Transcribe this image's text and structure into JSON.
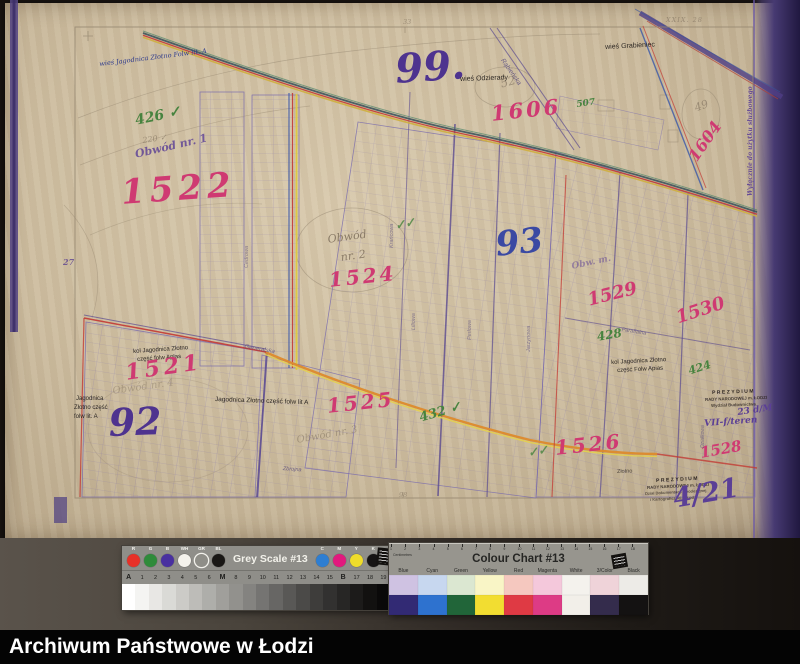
{
  "caption": {
    "text": "Archiwum Państwowe w Łodzi"
  },
  "palette": {
    "pink": "#cf3a72",
    "purple": "#4e338f",
    "blue": "#3a49a3",
    "ink": "#2d3a8c",
    "black": "#2b2622",
    "green": "#47833f",
    "pencil": "#8a7b67",
    "stamp": "#2c2420",
    "hand": "#5b3f96",
    "street": "#564a7e",
    "paper": "#cdbda0",
    "edge_band": "#544683",
    "road_orange": "#dd8a2c",
    "road_red": "#c33a33",
    "road_yellow": "#ddc93f",
    "road_blue": "#3a57a8"
  },
  "map": {
    "annotations": [
      {
        "n": "village-label-jagodnica-folw",
        "t": "wieś Jagodnica Złotno Folw lit. A",
        "x": 99,
        "y": 61,
        "s": 6.5,
        "st": "ink",
        "r": -7
      },
      {
        "n": "green-number-426",
        "t": "426 ✓",
        "x": 134,
        "y": 114,
        "s": 14,
        "st": "green",
        "r": -12
      },
      {
        "n": "pencil-number-220",
        "t": "220 ✓",
        "x": 142,
        "y": 137,
        "s": 8,
        "st": "pencil",
        "r": -8,
        "o": 0.7
      },
      {
        "n": "obwod-label-1",
        "t": "Obwód nr. 1",
        "x": 134,
        "y": 149,
        "s": 11,
        "st": "hand",
        "r": -13,
        "o": 0.8
      },
      {
        "n": "parcel-number-1522",
        "t": "1522",
        "x": 120,
        "y": 176,
        "s": 34,
        "st": "pink",
        "r": -4,
        "ls": 5
      },
      {
        "n": "district-number-99",
        "t": "99.",
        "x": 394,
        "y": 50,
        "s": 40,
        "st": "purple",
        "r": -4
      },
      {
        "n": "village-label-odzierady",
        "t": "wieś Odzierady",
        "x": 460,
        "y": 76,
        "s": 7,
        "st": "black",
        "r": -2
      },
      {
        "n": "pencil-number-52",
        "t": "52",
        "x": 499,
        "y": 78,
        "s": 12,
        "st": "pencil",
        "r": -15,
        "o": 0.7
      },
      {
        "n": "parcel-number-1606",
        "t": "1606",
        "x": 490,
        "y": 103,
        "s": 21,
        "st": "pink",
        "r": -6,
        "ls": 3
      },
      {
        "n": "green-number-507",
        "t": "507",
        "x": 576,
        "y": 101,
        "s": 9,
        "st": "green",
        "r": -8
      },
      {
        "n": "village-label-grabieniec",
        "t": "wieś Grabieniec",
        "x": 605,
        "y": 44,
        "s": 7,
        "st": "black",
        "r": -3
      },
      {
        "n": "sheet-number-top",
        "t": "XXIX. 28",
        "x": 666,
        "y": 17,
        "s": 6.5,
        "st": "pencil",
        "ls": 1,
        "o": 0.75
      },
      {
        "n": "margin-number-33",
        "t": "33",
        "x": 403,
        "y": 19,
        "s": 6.5,
        "st": "pencil",
        "o": 0.7
      },
      {
        "n": "parcel-number-1604",
        "t": "1604",
        "x": 686,
        "y": 155,
        "s": 16,
        "st": "pink",
        "r": -55
      },
      {
        "n": "pencil-number-49",
        "t": "49",
        "x": 693,
        "y": 103,
        "s": 11,
        "st": "pencil",
        "r": -20,
        "o": 0.75
      },
      {
        "n": "stamp-official-use",
        "t": "Wyłącznie do użytku służbowego",
        "x": 748,
        "y": 196,
        "s": 6,
        "st": "hand",
        "r": -90,
        "o": 0.9
      },
      {
        "n": "margin-number-27",
        "t": "27",
        "x": 63,
        "y": 258,
        "s": 8,
        "st": "purple",
        "o": 0.7
      },
      {
        "n": "district-number-93",
        "t": "93",
        "x": 494,
        "y": 228,
        "s": 34,
        "st": "blue",
        "r": -6
      },
      {
        "n": "green-check-marks",
        "t": "✓✓",
        "x": 394,
        "y": 220,
        "s": 12,
        "st": "green",
        "r": -12,
        "o": 0.8
      },
      {
        "n": "obwod-label-2-line1",
        "t": "Obwód",
        "x": 327,
        "y": 234,
        "s": 11,
        "st": "pencil",
        "r": -8
      },
      {
        "n": "obwod-label-2-line2",
        "t": "nr. 2",
        "x": 340,
        "y": 252,
        "s": 11,
        "st": "pencil",
        "r": -8
      },
      {
        "n": "parcel-number-1524",
        "t": "1524",
        "x": 328,
        "y": 270,
        "s": 20,
        "st": "pink",
        "r": -6,
        "ls": 3
      },
      {
        "n": "pencil-scrawl-obw",
        "t": "Obw. m.",
        "x": 571,
        "y": 263,
        "s": 9,
        "st": "hand",
        "r": -12,
        "o": 0.5
      },
      {
        "n": "parcel-number-1529",
        "t": "1529",
        "x": 586,
        "y": 292,
        "s": 18,
        "st": "pink",
        "r": -14
      },
      {
        "n": "green-number-428",
        "t": "428",
        "x": 596,
        "y": 331,
        "s": 12,
        "st": "green",
        "r": -10
      },
      {
        "n": "parcel-number-1530",
        "t": "1530",
        "x": 674,
        "y": 310,
        "s": 18,
        "st": "pink",
        "r": -18
      },
      {
        "n": "settlement-label-kol-jagodnica-east-1",
        "t": "kol Jagodnica Złotno",
        "x": 611,
        "y": 360,
        "s": 6,
        "st": "black",
        "r": -3
      },
      {
        "n": "settlement-label-kol-jagodnica-east-2",
        "t": "część Folw Apias",
        "x": 617,
        "y": 368,
        "s": 6,
        "st": "black",
        "r": -3
      },
      {
        "n": "green-number-424",
        "t": "424",
        "x": 687,
        "y": 366,
        "s": 11,
        "st": "green",
        "r": -18
      },
      {
        "n": "settlement-label-kol-jagodnica-west-1",
        "t": "kol Jagodnica Złotno",
        "x": 133,
        "y": 349,
        "s": 6,
        "st": "black",
        "r": -4
      },
      {
        "n": "settlement-label-kol-jagodnica-west-2",
        "t": "część folw Aplas",
        "x": 137,
        "y": 357,
        "s": 6,
        "st": "black",
        "r": -4
      },
      {
        "n": "parcel-number-1521",
        "t": "1521",
        "x": 124,
        "y": 362,
        "s": 22,
        "st": "pink",
        "r": -8,
        "ls": 4
      },
      {
        "n": "obwod-label-4",
        "t": "Obwód nr. 4",
        "x": 112,
        "y": 387,
        "s": 10,
        "st": "pencil",
        "r": -8,
        "o": 0.5
      },
      {
        "n": "settlement-label-jagodnica-a-1",
        "t": "Jagodnica",
        "x": 76,
        "y": 396,
        "s": 6,
        "st": "black"
      },
      {
        "n": "settlement-label-jagodnica-a-2",
        "t": "Złotno część",
        "x": 74,
        "y": 405,
        "s": 6,
        "st": "black"
      },
      {
        "n": "settlement-label-jagodnica-a-3",
        "t": "folw lit. A",
        "x": 74,
        "y": 414,
        "s": 6,
        "st": "black"
      },
      {
        "n": "district-number-92",
        "t": "92",
        "x": 108,
        "y": 404,
        "s": 38,
        "st": "purple",
        "r": -2
      },
      {
        "n": "settlement-label-jagodnica-row",
        "t": "Jagodnica Złotno część folw lit A",
        "x": 215,
        "y": 397,
        "s": 6.5,
        "st": "black",
        "r": 2
      },
      {
        "n": "street-label-generalska",
        "t": "Generalska",
        "x": 245,
        "y": 344,
        "s": 6,
        "st": "street",
        "r": 10,
        "o": 0.75
      },
      {
        "n": "parcel-number-1525",
        "t": "1525",
        "x": 326,
        "y": 396,
        "s": 20,
        "st": "pink",
        "r": -6,
        "ls": 3
      },
      {
        "n": "green-number-432",
        "t": "432 ✓",
        "x": 418,
        "y": 412,
        "s": 13,
        "st": "green",
        "r": -16
      },
      {
        "n": "obwod-label-3",
        "t": "Obwód nr. 3",
        "x": 296,
        "y": 436,
        "s": 10,
        "st": "pencil",
        "r": -10,
        "o": 0.6
      },
      {
        "n": "street-label-zbrojna",
        "t": "Zbrojna",
        "x": 283,
        "y": 467,
        "s": 5.5,
        "st": "street",
        "r": 4,
        "o": 0.8
      },
      {
        "n": "street-label-zlotno",
        "t": "Złotno",
        "x": 617,
        "y": 470,
        "s": 5.5,
        "st": "black",
        "r": -2,
        "o": 0.8
      },
      {
        "n": "parcel-number-1526",
        "t": "1526",
        "x": 554,
        "y": 438,
        "s": 20,
        "st": "pink",
        "r": -6,
        "ls": 3
      },
      {
        "n": "green-scrawl-1526",
        "t": "✓✓",
        "x": 527,
        "y": 447,
        "s": 12,
        "st": "green",
        "r": -10,
        "o": 0.8
      },
      {
        "n": "parcel-number-1528",
        "t": "1528",
        "x": 699,
        "y": 446,
        "s": 15,
        "st": "pink",
        "r": -10
      },
      {
        "n": "margin-number-98",
        "t": "98",
        "x": 399,
        "y": 492,
        "s": 6.5,
        "st": "pencil",
        "o": 0.7
      },
      {
        "n": "stamp-prezydium-top-line1",
        "t": "PREZYDIUM",
        "x": 712,
        "y": 391,
        "s": 5,
        "st": "stamp",
        "r": -2,
        "ls": 1.5
      },
      {
        "n": "stamp-prezydium-top-line2",
        "t": "RADY NARODOWEJ m. ŁODZI",
        "x": 705,
        "y": 398,
        "s": 4.3,
        "st": "stamp",
        "r": -2,
        "o": 0.85
      },
      {
        "n": "stamp-prezydium-top-line3",
        "t": "Wydział Budownictwa",
        "x": 711,
        "y": 404,
        "s": 4.3,
        "st": "stamp",
        "r": -2,
        "o": 0.8
      },
      {
        "n": "handwritten-date",
        "t": "23 d/M",
        "x": 737,
        "y": 409,
        "s": 9,
        "st": "hand",
        "r": -8
      },
      {
        "n": "handwritten-ref",
        "t": "VII-f/teren",
        "x": 704,
        "y": 420,
        "s": 9,
        "st": "hand",
        "r": -4
      },
      {
        "n": "stamp-prezydium-bottom-line1",
        "t": "PREZYDIUM",
        "x": 656,
        "y": 479,
        "s": 5,
        "st": "stamp",
        "r": -3,
        "ls": 1.5
      },
      {
        "n": "stamp-prezydium-bottom-line2",
        "t": "RADY NARODOWEJ m. ŁODZI",
        "x": 647,
        "y": 486,
        "s": 4.3,
        "st": "stamp",
        "r": -3,
        "o": 0.85
      },
      {
        "n": "stamp-prezydium-bottom-line3",
        "t": "Dział Dokumentacji Geodezyjnej",
        "x": 645,
        "y": 492,
        "s": 4,
        "st": "stamp",
        "r": -3,
        "o": 0.7
      },
      {
        "n": "stamp-prezydium-bottom-line4",
        "t": "i Kartograficznej w Łodzi",
        "x": 650,
        "y": 498,
        "s": 4,
        "st": "stamp",
        "r": -3,
        "o": 0.65
      },
      {
        "n": "archive-number",
        "t": "4/21",
        "x": 671,
        "y": 486,
        "s": 27,
        "st": "hand",
        "r": -10
      },
      {
        "n": "street-label-rabienska",
        "t": "Rąbieńska",
        "x": 504,
        "y": 58,
        "s": 6.5,
        "st": "street",
        "r": 55,
        "o": 0.85
      },
      {
        "n": "street-label-krancowa",
        "t": "Krańcowa",
        "x": 390,
        "y": 248,
        "s": 5.5,
        "st": "street",
        "r": -90,
        "o": 0.65
      },
      {
        "n": "street-label-cedrowa",
        "t": "Cedrowa",
        "x": 245,
        "y": 268,
        "s": 5.5,
        "st": "street",
        "r": -90,
        "o": 0.6
      },
      {
        "n": "street-label-liliowa",
        "t": "Liliowa",
        "x": 412,
        "y": 330,
        "s": 5.5,
        "st": "street",
        "r": -90,
        "o": 0.6
      },
      {
        "n": "street-label-perlowa",
        "t": "Perłowa",
        "x": 468,
        "y": 340,
        "s": 5.5,
        "st": "street",
        "r": -90,
        "o": 0.6
      },
      {
        "n": "street-label-jarzynowa",
        "t": "Jarzynowa",
        "x": 527,
        "y": 352,
        "s": 5.5,
        "st": "street",
        "r": -90,
        "o": 0.6
      },
      {
        "n": "street-label-parafialna",
        "t": "Parafialna",
        "x": 622,
        "y": 328,
        "s": 5.5,
        "st": "street",
        "r": 9,
        "o": 0.7
      },
      {
        "n": "street-label-dzialkowa",
        "t": "Działkowa",
        "x": 701,
        "y": 448,
        "s": 5,
        "st": "street",
        "r": -90,
        "o": 0.65
      }
    ]
  },
  "grey_scale": {
    "title": "Grey Scale #13",
    "dots_left": [
      {
        "label": "R",
        "color": "#e73128"
      },
      {
        "label": "G",
        "color": "#2e8b3a"
      },
      {
        "label": "B",
        "color": "#4930a0"
      },
      {
        "label": "WH",
        "color": "#f4f2ec"
      },
      {
        "label": "GR",
        "color": "#8f8e88",
        "ring": true
      },
      {
        "label": "BL",
        "color": "#191715"
      }
    ],
    "dots_right": [
      {
        "label": "C",
        "color": "#2e7ed2"
      },
      {
        "label": "M",
        "color": "#e2197e"
      },
      {
        "label": "Y",
        "color": "#efdc2b"
      },
      {
        "label": "K",
        "color": "#161414"
      }
    ],
    "steps": [
      "A",
      "1",
      "2",
      "3",
      "4",
      "5",
      "6",
      "M",
      "8",
      "9",
      "10",
      "11",
      "12",
      "13",
      "14",
      "15",
      "B",
      "17",
      "18",
      "19"
    ],
    "gradient": [
      "#ffffff",
      "#f4f4f2",
      "#e8e7e4",
      "#dadad6",
      "#cccbc7",
      "#bdbcb8",
      "#aeaeaa",
      "#a09f9b",
      "#92918d",
      "#848380",
      "#757472",
      "#676664",
      "#595856",
      "#4b4a48",
      "#3e3d3b",
      "#323130",
      "#272625",
      "#1c1b1a",
      "#121110",
      "#0a0909"
    ]
  },
  "colour_chart": {
    "title": "Colour Chart #13",
    "ruler_label": "Centimetres",
    "ruler_numbers": [
      "1",
      "2",
      "3",
      "4",
      "5",
      "6",
      "7",
      "8",
      "9",
      "10",
      "11",
      "12",
      "13",
      "14",
      "15",
      "16",
      "17",
      "18"
    ],
    "columns": [
      {
        "label": "Blue",
        "light": "#cfc2e2",
        "full": "#322a74"
      },
      {
        "label": "Cyan",
        "light": "#c7d7ef",
        "full": "#2e72cf"
      },
      {
        "label": "Green",
        "light": "#dbe7d1",
        "full": "#216539"
      },
      {
        "label": "Yellow",
        "light": "#f9f5c6",
        "full": "#f2dd31"
      },
      {
        "label": "Red",
        "light": "#f5c8bf",
        "full": "#df3a44"
      },
      {
        "label": "Magenta",
        "light": "#f4c8db",
        "full": "#dd3b85"
      },
      {
        "label": "White",
        "light": "#f4f2ed",
        "full": "#f2efe9"
      },
      {
        "label": "3/Color",
        "light": "#efd3d9",
        "full": "#342c4c"
      },
      {
        "label": "Black",
        "light": "#edebe7",
        "full": "#141212"
      }
    ]
  }
}
